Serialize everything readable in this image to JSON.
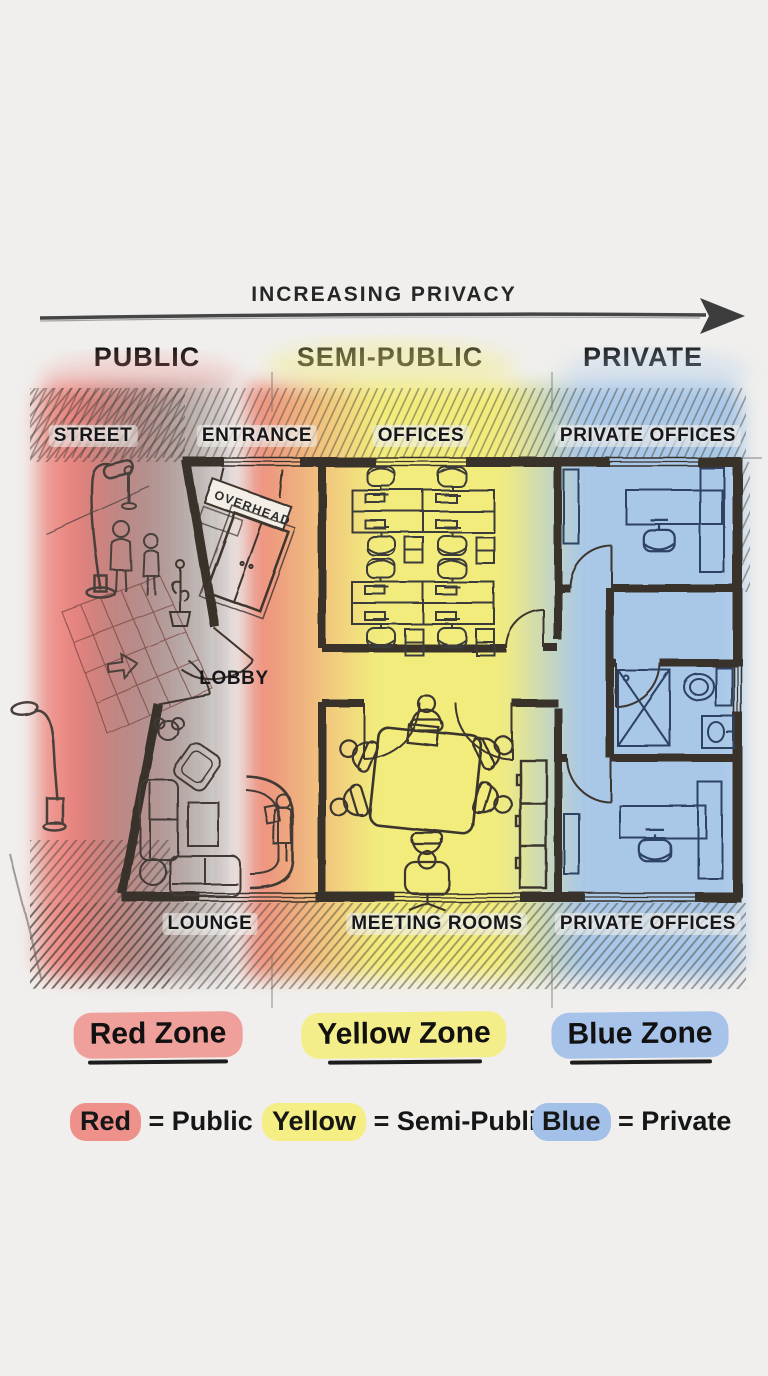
{
  "header": {
    "title": "INCREASING PRIVACY"
  },
  "columns": [
    {
      "label": "PUBLIC"
    },
    {
      "label": "SEMI-PUBLIC"
    },
    {
      "label": "PRIVATE"
    }
  ],
  "plan": {
    "labels": {
      "street": "STREET",
      "entrance": "ENTRANCE",
      "offices": "OFFICES",
      "private_offices_top": "PRIVATE OFFICES",
      "lobby": "LOBBY",
      "lounge": "LOUNGE",
      "meeting_rooms": "MEETING ROOMS",
      "private_offices_bottom": "PRIVATE OFFICES",
      "overhead_sign": "OVERHEAD"
    },
    "colors": {
      "red_zone": "#ec837e",
      "yellow_zone": "#f2ec7d",
      "blue_zone": "#a9c8e8",
      "wall": "#38322c",
      "paper": "#f0efed"
    }
  },
  "zones": [
    {
      "name": "Red Zone",
      "highlight": "#f0a09a"
    },
    {
      "name": "Yellow Zone",
      "highlight": "#f4ee8a"
    },
    {
      "name": "Blue Zone",
      "highlight": "#a7c3ea"
    }
  ],
  "legend": [
    {
      "term": "Red",
      "definition": "= Public",
      "highlight": "#ee918b"
    },
    {
      "term": "Yellow",
      "definition": "= Semi-Public",
      "highlight": "#f4ee85"
    },
    {
      "term": "Blue",
      "definition": "= Private",
      "highlight": "#a2c0e8"
    }
  ]
}
